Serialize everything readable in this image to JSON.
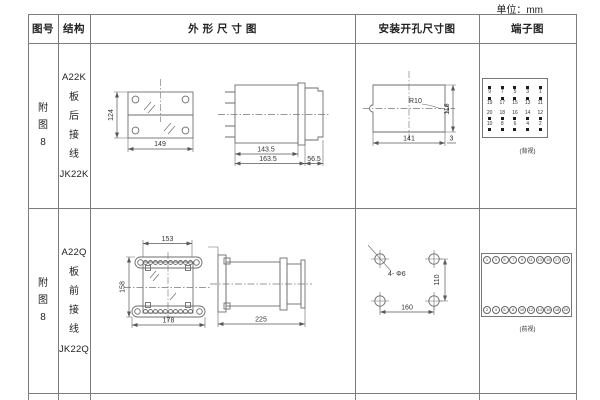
{
  "unit_label": "单位：mm",
  "header": {
    "figure_no": "图号",
    "structure": "结构",
    "outline": "外 形 尺 寸 图",
    "install": "安装开孔尺寸图",
    "terminal": "端子图"
  },
  "rows": [
    {
      "figure_no": "附图8",
      "structure": {
        "model_top": "A22K",
        "wiring": "板后接线",
        "model_bottom": "JK22K"
      },
      "outline": {
        "front_height": "124",
        "front_width": "149",
        "side_body": "143.5",
        "side_total": "163.5",
        "side_rear": "56.5"
      },
      "install": {
        "radius": "R10",
        "width": "141",
        "height": "116",
        "edge": "3"
      },
      "terminal": {
        "grid": [
          [
            "9",
            "7",
            "5",
            "3",
            "1"
          ],
          [
            "19",
            "17",
            "15",
            "13",
            "11"
          ],
          [
            "20",
            "18",
            "16",
            "14",
            "12"
          ],
          [
            "10",
            "8",
            "6",
            "4",
            "2"
          ]
        ],
        "view_label": "(背视)"
      }
    },
    {
      "figure_no": "附图8",
      "structure": {
        "model_top": "A22Q",
        "wiring": "板前接线",
        "model_bottom": "JK22Q"
      },
      "outline": {
        "top_width": "153",
        "front_height": "158",
        "bottom_width": "178",
        "side_length": "225"
      },
      "install": {
        "holes": "4- Φ6",
        "width": "160",
        "height": "110"
      },
      "terminal": {
        "top": [
          "1",
          "3",
          "5",
          "7",
          "9",
          "11",
          "13",
          "15",
          "17",
          "19"
        ],
        "bottom": [
          "2",
          "4",
          "6",
          "8",
          "10",
          "12",
          "14",
          "16",
          "18",
          "20"
        ],
        "view_label": "(前视)"
      }
    }
  ]
}
